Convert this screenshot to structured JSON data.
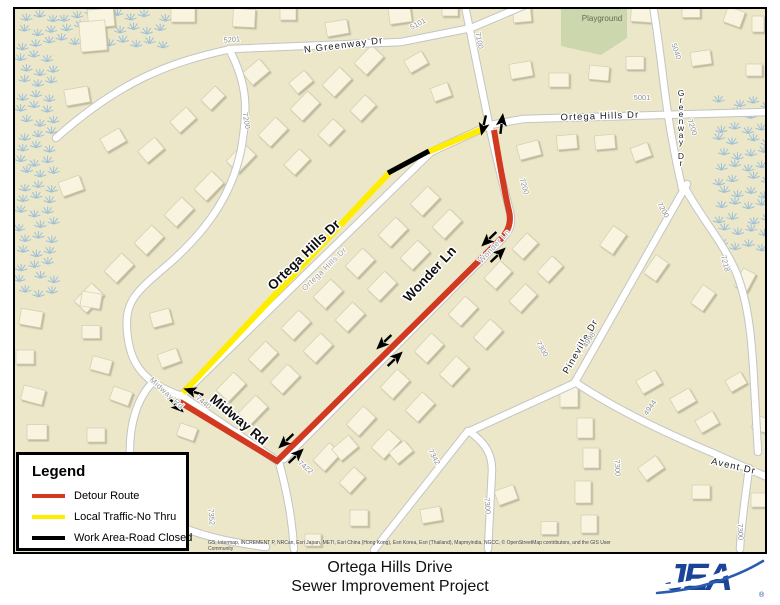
{
  "map": {
    "colors": {
      "background": "#ebe7c8",
      "house_fill": "#f8f4e0",
      "house_stroke": "#d2ceb2",
      "road_casing": "#c4c4c4",
      "road_fill": "#ffffff",
      "playground_fill": "#cdd7ae",
      "wetland": "#92b9dc",
      "detour_red": "#d13a21",
      "local_yellow": "#ffed00",
      "work_black": "#000000"
    },
    "attribution": "GS, Intermap, INCREMENT P, NRCan, Esri Japan, METI, Esri China (Hong Kong), Esri Korea, Esri (Thailand), Mapmyindia, NGCC, © OpenStreetMap contributors, and the GIS User Community",
    "playground": {
      "points": "560,8 626,8 626,38 600,55 560,46"
    },
    "wetland_regions": [
      {
        "x": 17,
        "y": 14,
        "w": 42,
        "h": 282
      },
      {
        "x": 58,
        "y": 12,
        "w": 104,
        "h": 44
      },
      {
        "x": 716,
        "y": 98,
        "w": 48,
        "h": 156
      }
    ],
    "roads": [
      {
        "name": "n-greenway-dr",
        "d": "M55,138 C120,80 170,62 230,49 L400,42 L470,28 L522,6"
      },
      {
        "name": "midway-rd-upper",
        "d": "M228,49 C247,85 247,110 240,150 C230,200 200,235 170,262 C135,292 124,300 126,330 C128,358 138,372 152,382 C164,390 172,393 181,396 L278,462"
      },
      {
        "name": "midway-south",
        "d": "M152,382 C136,398 128,425 129,455 C130,492 148,514 180,527 C208,538 235,543 265,547"
      },
      {
        "name": "road-7422",
        "d": "M278,462 C286,492 291,518 293,549"
      },
      {
        "name": "ortega-hills-dr",
        "d": "M181,395 L430,152 L489,125 L522,119 L766,112"
      },
      {
        "name": "wonder-ln",
        "d": "M464,6 C474,55 483,100 488,124 C496,162 505,196 509,212 C512,225 508,232 499,241 L283,459"
      },
      {
        "name": "greenway-dr",
        "d": "M652,6 C658,40 662,80 666,108 C671,142 676,166 681,188"
      },
      {
        "name": "pineville-dr",
        "d": "M686,184 L574,382"
      },
      {
        "name": "road-7218",
        "d": "M683,186 C696,212 722,242 735,272 C748,304 751,342 753,382 L757,452"
      },
      {
        "name": "road-7300-se",
        "d": "M748,468 C744,500 740,525 739,549"
      },
      {
        "name": "avent-dr",
        "d": "M574,382 C612,408 660,431 712,453 L766,477"
      },
      {
        "name": "avent-west",
        "d": "M574,383 L467,432"
      },
      {
        "name": "road-7342",
        "d": "M467,431 L373,550"
      },
      {
        "name": "road-7300-s",
        "d": "M469,432 C486,444 491,456 491,470 L487,549"
      }
    ],
    "routes": [
      {
        "name": "local-traffic-route",
        "color": "#ffed00",
        "width": 6,
        "d": "M182,393 L389,172 M427,152 L484,128"
      },
      {
        "name": "work-area-segment",
        "color": "#000000",
        "width": 5,
        "d": "M387,173 L428,151"
      },
      {
        "name": "detour-route",
        "color": "#d13a21",
        "width": 6,
        "d": "M179,402 L276,461 L497,242 C507,233 511,223 508,211 C503,190 498,160 493,130"
      }
    ],
    "arrows": [
      [
        482,
        128,
        103
      ],
      [
        501,
        121,
        -83
      ],
      [
        486,
        241,
        136
      ],
      [
        499,
        253,
        -44
      ],
      [
        381,
        344,
        136
      ],
      [
        396,
        357,
        -44
      ],
      [
        283,
        443,
        136
      ],
      [
        297,
        454,
        -44
      ],
      [
        190,
        391,
        198
      ],
      [
        177,
        407,
        44
      ]
    ],
    "street_labels": [
      {
        "t": "N Greenway Dr",
        "x": 343,
        "y": 48,
        "r": -7,
        "c": "street"
      },
      {
        "t": "Ortega Hills Dr",
        "x": 599,
        "y": 119,
        "r": -2,
        "c": "street"
      },
      {
        "t": "Greenway Dr",
        "x": 680,
        "y": 96,
        "r": 0,
        "c": "street",
        "v": true
      },
      {
        "t": "Ortega Hills Dr",
        "x": 306,
        "y": 258,
        "r": -44,
        "c": "big"
      },
      {
        "t": "Ortega Hills Dr",
        "x": 325,
        "y": 271,
        "r": -44,
        "c": "sm"
      },
      {
        "t": "Wonder Ln",
        "x": 432,
        "y": 277,
        "r": -47,
        "c": "big"
      },
      {
        "t": "Wonder Ln",
        "x": 495,
        "y": 248,
        "r": -47,
        "c": "sm"
      },
      {
        "t": "Midway Rd",
        "x": 235,
        "y": 423,
        "r": 40,
        "c": "big"
      },
      {
        "t": "Midway Rd",
        "x": 164,
        "y": 395,
        "r": 42,
        "c": "sm"
      },
      {
        "t": "Pineville Dr",
        "x": 582,
        "y": 348,
        "r": -60,
        "c": "street"
      },
      {
        "t": "Avent Dr",
        "x": 732,
        "y": 469,
        "r": 13,
        "c": "street"
      },
      {
        "t": "Playground",
        "x": 601,
        "y": 21,
        "r": 0,
        "c": "play"
      }
    ],
    "number_labels": [
      {
        "t": "5201",
        "x": 231,
        "y": 42,
        "r": -5
      },
      {
        "t": "5101",
        "x": 418,
        "y": 26,
        "r": -28
      },
      {
        "t": "7100",
        "x": 476,
        "y": 41,
        "r": 78
      },
      {
        "t": "5001",
        "x": 641,
        "y": 100,
        "r": 0
      },
      {
        "t": "5040",
        "x": 673,
        "y": 52,
        "r": 72
      },
      {
        "t": "7200",
        "x": 689,
        "y": 128,
        "r": 72
      },
      {
        "t": "7200",
        "x": 521,
        "y": 187,
        "r": 74
      },
      {
        "t": "7200",
        "x": 243,
        "y": 121,
        "r": 80
      },
      {
        "t": "7200",
        "x": 660,
        "y": 211,
        "r": 62
      },
      {
        "t": "7218",
        "x": 722,
        "y": 264,
        "r": 76
      },
      {
        "t": "4998",
        "x": 590,
        "y": 341,
        "r": -58
      },
      {
        "t": "4944",
        "x": 651,
        "y": 409,
        "r": -55
      },
      {
        "t": "7440",
        "x": 201,
        "y": 404,
        "r": 40
      },
      {
        "t": "7422",
        "x": 303,
        "y": 469,
        "r": 40
      },
      {
        "t": "7352",
        "x": 208,
        "y": 517,
        "r": 85
      },
      {
        "t": "7342",
        "x": 431,
        "y": 458,
        "r": 62
      },
      {
        "t": "7300",
        "x": 484,
        "y": 506,
        "r": 85
      },
      {
        "t": "7300",
        "x": 614,
        "y": 468,
        "r": 87
      },
      {
        "t": "7300",
        "x": 737,
        "y": 532,
        "r": 87
      },
      {
        "t": "7300",
        "x": 539,
        "y": 350,
        "r": 60
      }
    ],
    "houses": [
      [
        100,
        18,
        26,
        18,
        -5
      ],
      [
        182,
        14,
        24,
        16,
        0
      ],
      [
        243,
        18,
        22,
        18,
        3
      ],
      [
        287,
        13,
        16,
        14,
        0
      ],
      [
        336,
        28,
        22,
        14,
        -10
      ],
      [
        399,
        15,
        22,
        16,
        -8
      ],
      [
        449,
        10,
        16,
        12,
        0
      ],
      [
        521,
        14,
        18,
        16,
        -5
      ],
      [
        641,
        14,
        22,
        16,
        4
      ],
      [
        690,
        11,
        18,
        13,
        0
      ],
      [
        733,
        17,
        16,
        18,
        -70
      ],
      [
        757,
        24,
        12,
        16,
        0
      ],
      [
        92,
        36,
        26,
        30,
        -5
      ],
      [
        255,
        72,
        22,
        16,
        -40
      ],
      [
        300,
        82,
        20,
        14,
        -40
      ],
      [
        415,
        62,
        20,
        14,
        -30
      ],
      [
        440,
        92,
        18,
        14,
        -20
      ],
      [
        520,
        70,
        22,
        15,
        -10
      ],
      [
        558,
        80,
        20,
        14,
        0
      ],
      [
        598,
        73,
        20,
        14,
        5
      ],
      [
        634,
        63,
        18,
        13,
        0
      ],
      [
        700,
        58,
        20,
        14,
        -8
      ],
      [
        753,
        70,
        16,
        12,
        0
      ],
      [
        76,
        96,
        24,
        16,
        -10
      ],
      [
        112,
        140,
        22,
        15,
        -30
      ],
      [
        150,
        150,
        22,
        15,
        -40
      ],
      [
        182,
        120,
        22,
        15,
        -42
      ],
      [
        212,
        98,
        20,
        14,
        -45
      ],
      [
        70,
        186,
        22,
        15,
        -20
      ],
      [
        88,
        298,
        25,
        17,
        -46
      ],
      [
        118,
        268,
        25,
        17,
        -46
      ],
      [
        148,
        240,
        25,
        17,
        -46
      ],
      [
        178,
        212,
        25,
        17,
        -46
      ],
      [
        208,
        186,
        25,
        17,
        -46
      ],
      [
        240,
        158,
        25,
        17,
        -46
      ],
      [
        272,
        132,
        25,
        17,
        -46
      ],
      [
        304,
        106,
        25,
        17,
        -46
      ],
      [
        336,
        82,
        25,
        17,
        -46
      ],
      [
        368,
        60,
        25,
        17,
        -46
      ],
      [
        330,
        132,
        22,
        15,
        -46
      ],
      [
        362,
        108,
        22,
        15,
        -46
      ],
      [
        296,
        162,
        22,
        15,
        -46
      ],
      [
        230,
        387,
        25,
        17,
        -46
      ],
      [
        262,
        356,
        25,
        17,
        -46
      ],
      [
        295,
        325,
        25,
        17,
        -46
      ],
      [
        327,
        294,
        25,
        17,
        -46
      ],
      [
        359,
        263,
        25,
        17,
        -46
      ],
      [
        392,
        232,
        25,
        17,
        -46
      ],
      [
        424,
        201,
        25,
        17,
        -46
      ],
      [
        252,
        410,
        25,
        17,
        -46
      ],
      [
        284,
        379,
        25,
        17,
        -46
      ],
      [
        317,
        348,
        25,
        17,
        -46
      ],
      [
        349,
        317,
        25,
        17,
        -46
      ],
      [
        381,
        286,
        25,
        17,
        -46
      ],
      [
        414,
        255,
        25,
        17,
        -46
      ],
      [
        446,
        224,
        25,
        17,
        -46
      ],
      [
        326,
        457,
        24,
        16,
        -47
      ],
      [
        360,
        421,
        25,
        17,
        -47
      ],
      [
        394,
        384,
        25,
        17,
        -47
      ],
      [
        428,
        348,
        25,
        17,
        -47
      ],
      [
        462,
        311,
        25,
        17,
        -47
      ],
      [
        497,
        275,
        24,
        16,
        -47
      ],
      [
        524,
        246,
        22,
        15,
        -47
      ],
      [
        351,
        480,
        22,
        15,
        -47
      ],
      [
        385,
        444,
        25,
        17,
        -47
      ],
      [
        419,
        407,
        25,
        17,
        -47
      ],
      [
        453,
        371,
        25,
        17,
        -47
      ],
      [
        487,
        334,
        25,
        17,
        -47
      ],
      [
        522,
        298,
        24,
        16,
        -47
      ],
      [
        549,
        269,
        22,
        15,
        -47
      ],
      [
        528,
        150,
        22,
        15,
        -15
      ],
      [
        566,
        142,
        20,
        14,
        -5
      ],
      [
        604,
        142,
        20,
        14,
        -5
      ],
      [
        640,
        152,
        14,
        18,
        70
      ],
      [
        612,
        240,
        24,
        16,
        -55
      ],
      [
        655,
        268,
        22,
        15,
        -55
      ],
      [
        702,
        298,
        22,
        15,
        -55
      ],
      [
        744,
        280,
        20,
        14,
        -62
      ],
      [
        568,
        396,
        18,
        22,
        0
      ],
      [
        584,
        428,
        16,
        20,
        0
      ],
      [
        590,
        458,
        16,
        20,
        0
      ],
      [
        582,
        492,
        16,
        22,
        0
      ],
      [
        588,
        524,
        16,
        18,
        0
      ],
      [
        648,
        382,
        22,
        15,
        -30
      ],
      [
        682,
        400,
        22,
        15,
        -30
      ],
      [
        706,
        422,
        20,
        14,
        -30
      ],
      [
        650,
        468,
        22,
        15,
        -35
      ],
      [
        700,
        492,
        18,
        14,
        0
      ],
      [
        758,
        500,
        16,
        14,
        0
      ],
      [
        760,
        424,
        16,
        14,
        20
      ],
      [
        735,
        382,
        18,
        13,
        -30
      ],
      [
        344,
        448,
        22,
        15,
        -40
      ],
      [
        400,
        452,
        20,
        14,
        -40
      ],
      [
        358,
        518,
        18,
        16,
        0
      ],
      [
        430,
        515,
        20,
        14,
        -10
      ],
      [
        505,
        495,
        20,
        15,
        -20
      ],
      [
        548,
        528,
        16,
        13,
        0
      ],
      [
        312,
        540,
        16,
        12,
        0
      ],
      [
        186,
        432,
        18,
        13,
        20
      ],
      [
        30,
        318,
        22,
        16,
        10
      ],
      [
        24,
        357,
        18,
        14,
        0
      ],
      [
        32,
        395,
        22,
        15,
        15
      ],
      [
        36,
        432,
        20,
        15,
        0
      ],
      [
        90,
        300,
        20,
        15,
        10
      ],
      [
        90,
        332,
        18,
        13,
        0
      ],
      [
        100,
        365,
        20,
        14,
        15
      ],
      [
        120,
        396,
        20,
        14,
        20
      ],
      [
        95,
        435,
        18,
        14,
        0
      ],
      [
        160,
        318,
        20,
        15,
        -15
      ],
      [
        168,
        358,
        20,
        14,
        -20
      ]
    ]
  },
  "legend": {
    "title": "Legend",
    "items": [
      {
        "label": "Detour Route",
        "color": "#d13a21"
      },
      {
        "label": "Local Traffic-No Thru",
        "color": "#ffed00"
      },
      {
        "label": "Work Area-Road Closed",
        "color": "#000000"
      }
    ]
  },
  "footer": {
    "title_line1": "Ortega Hills Drive",
    "title_line2": "Sewer Improvement Project",
    "logo_text": "JEA",
    "logo_color": "#1b4397"
  }
}
